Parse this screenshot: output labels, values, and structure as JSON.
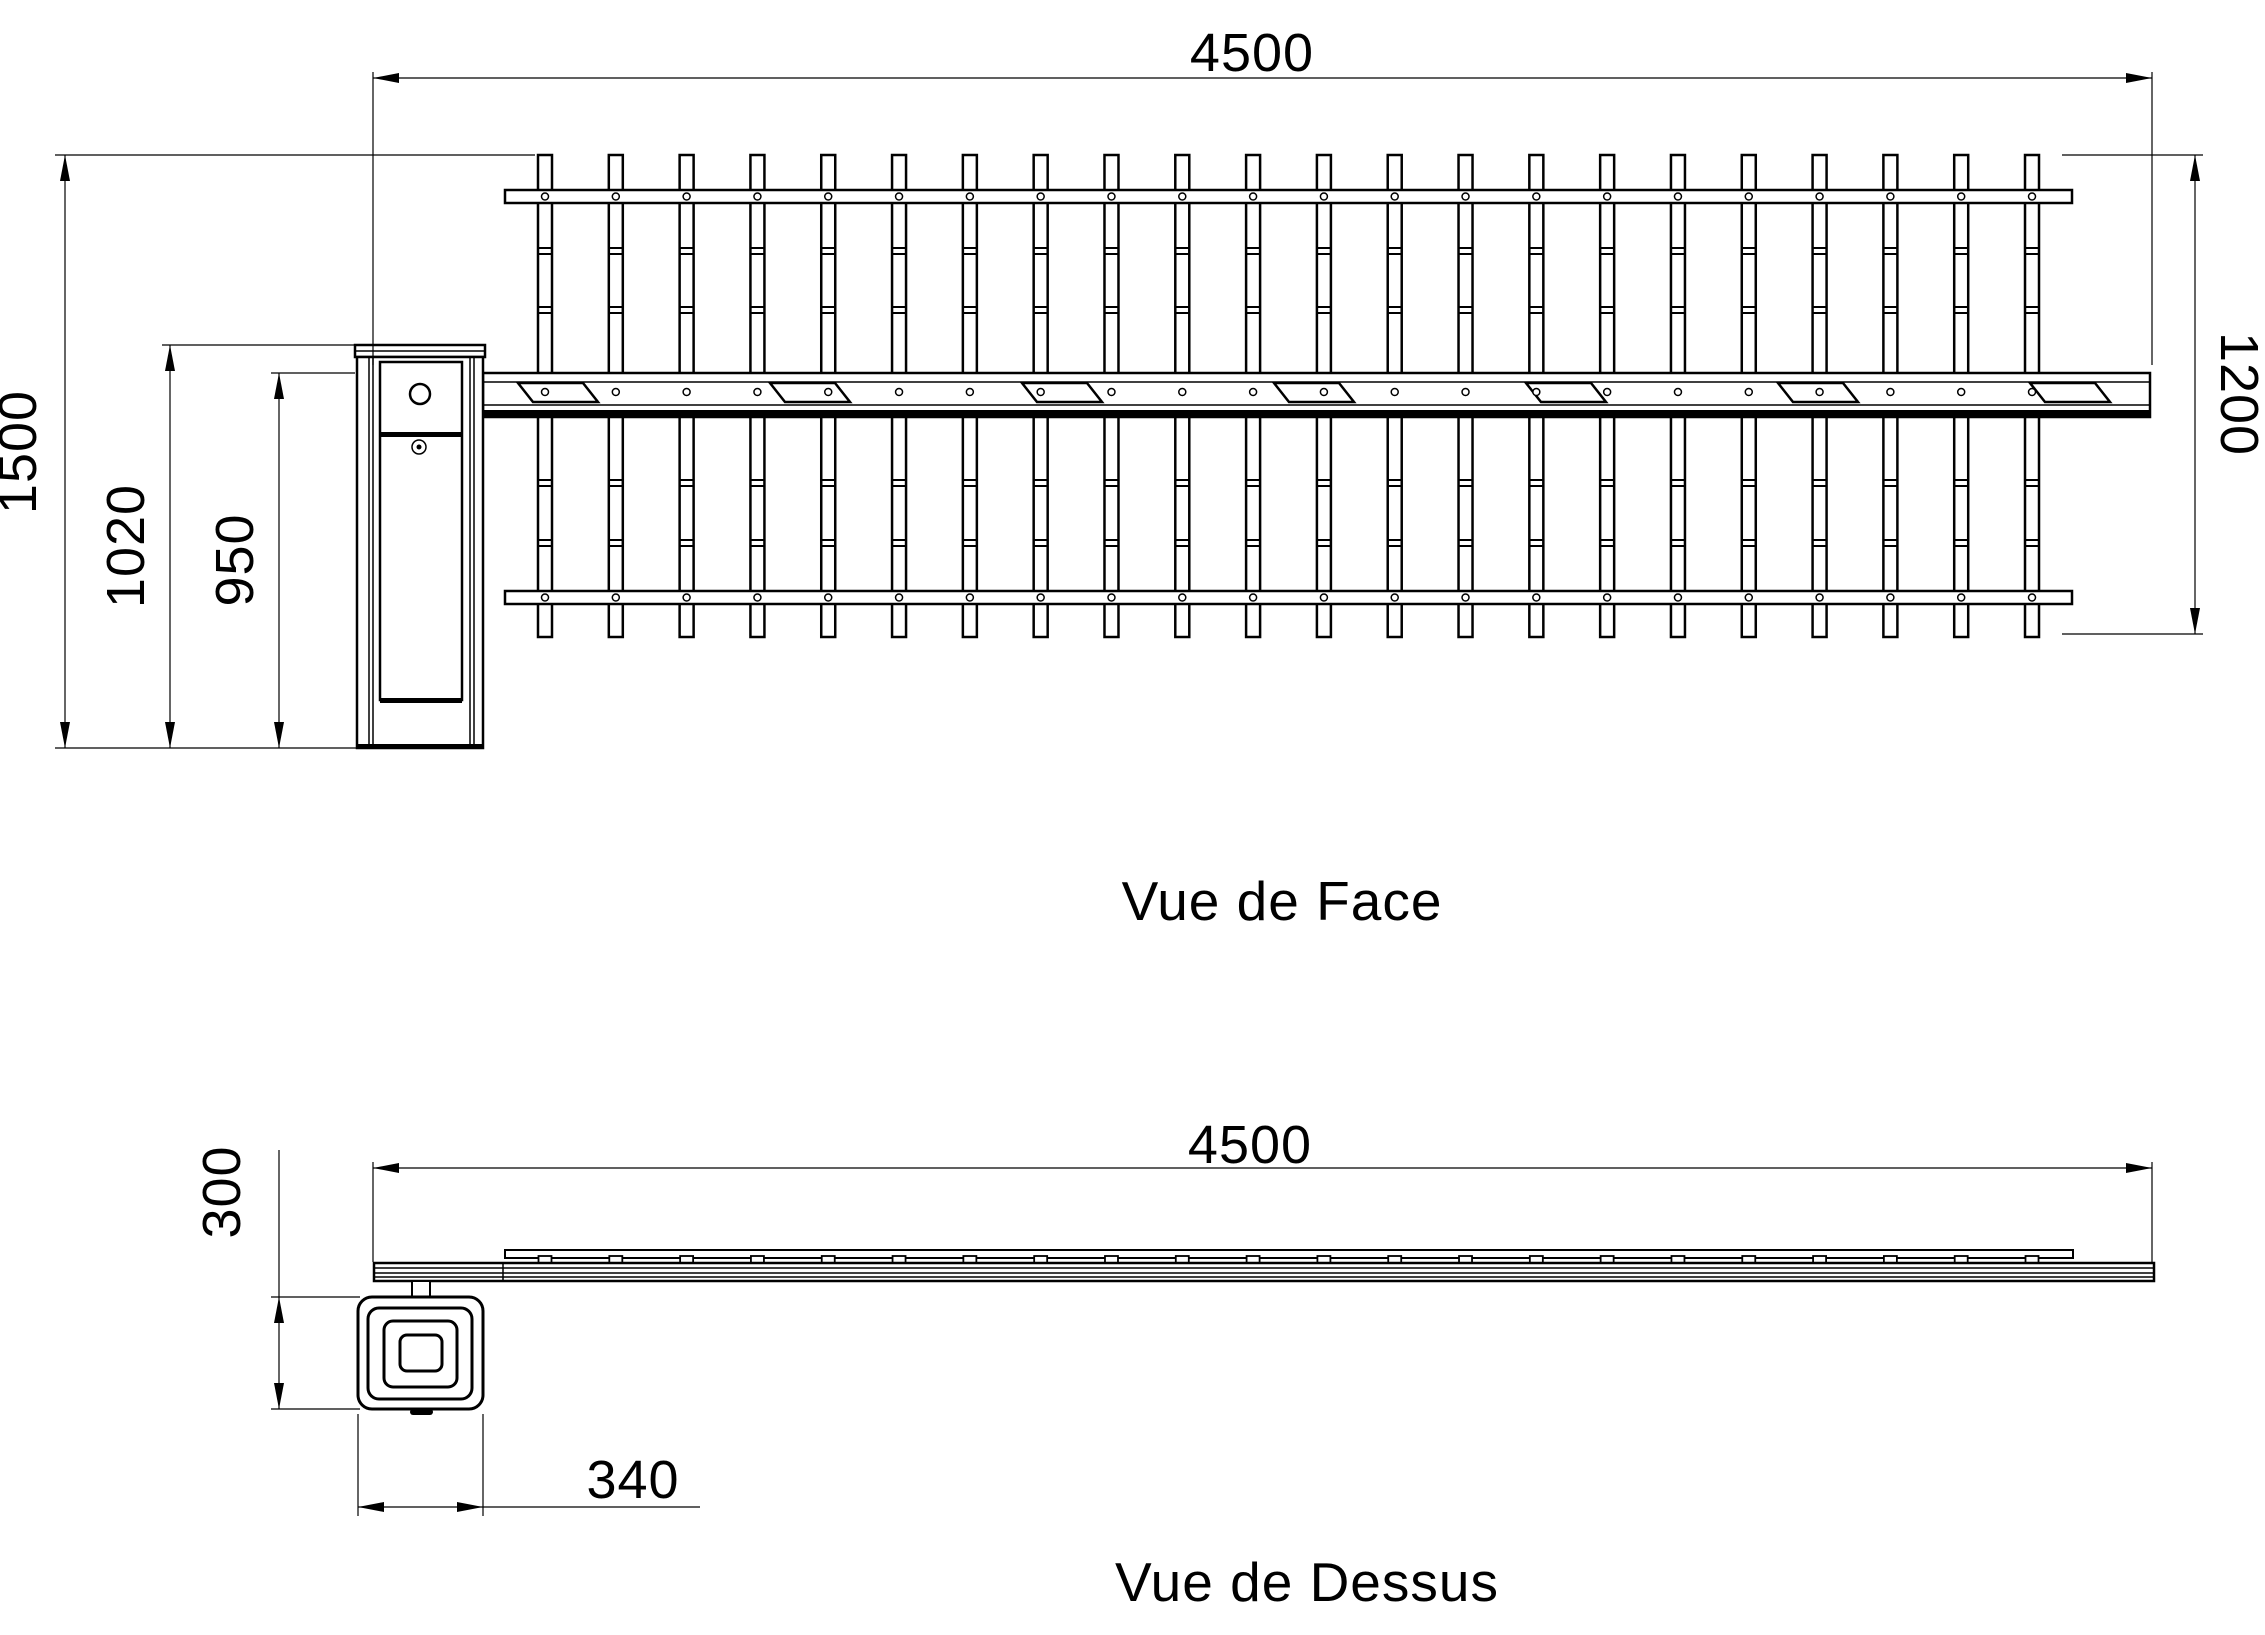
{
  "titles": {
    "front": "Vue de Face",
    "top": "Vue de Dessus"
  },
  "labels": {
    "front_length": "4500",
    "total_height": "1500",
    "post_height": "1020",
    "boom_axis_height": "950",
    "skirt_height": "1200",
    "top_length": "4500",
    "post_depth": "300",
    "post_width": "340"
  },
  "colors": {
    "line": "#000000",
    "background": "#ffffff"
  },
  "geometry": {
    "pickets": {
      "count": 22,
      "first_cx": 545,
      "spacing": 70.81,
      "width": 14,
      "top": 155,
      "bottom": 637,
      "joint_ys": [
        248,
        307,
        480,
        540
      ]
    },
    "rails": {
      "x1": 505,
      "x2": 2072,
      "top_y": 190,
      "bottom_y": 591,
      "h": 13,
      "rivet_r": 3.5
    },
    "boom": {
      "x1": 483,
      "x2": 2150,
      "y1": 373,
      "y2": 417,
      "rivet_y": 392
    },
    "stickers": {
      "xs": [
        518,
        770,
        1022,
        1274,
        1526,
        1778,
        2030
      ],
      "y1": 383,
      "y2": 402,
      "w": 65,
      "shear": 15
    },
    "top_view": {
      "tab_y": 1256,
      "tab_h": 7,
      "tab_w": 13
    }
  }
}
